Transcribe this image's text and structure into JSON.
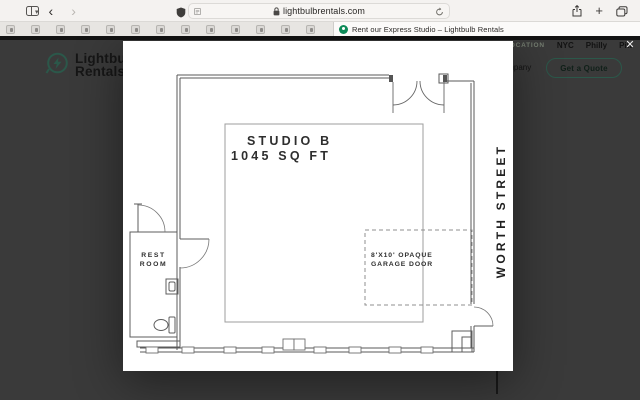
{
  "browser": {
    "url": "lightbulbrentals.com",
    "tab_title": "Rent our Express Studio – Lightbulb Rentals",
    "plus_glyph": "+"
  },
  "site": {
    "logo_line1": "Lightbulb",
    "logo_line2": "Rentals",
    "nav": {
      "location_label": "LOCATION",
      "cities": [
        "NYC",
        "Philly",
        "Pitt"
      ],
      "partial_item": "Company",
      "cta_label": "Get a Quote"
    },
    "modal_close_glyph": "✕"
  },
  "floor_plan": {
    "title": "STUDIO B",
    "area": "1045 SQ FT",
    "street_label": "WORTH STREET",
    "restroom_line1": "REST",
    "restroom_line2": "ROOM",
    "garage_line1": "8'X10' OPAQUE",
    "garage_line2": "GARAGE DOOR"
  },
  "colors": {
    "accent_green": "#2b584a",
    "favicon_green": "#0d8a58",
    "overlay": "#3a3a3a"
  }
}
